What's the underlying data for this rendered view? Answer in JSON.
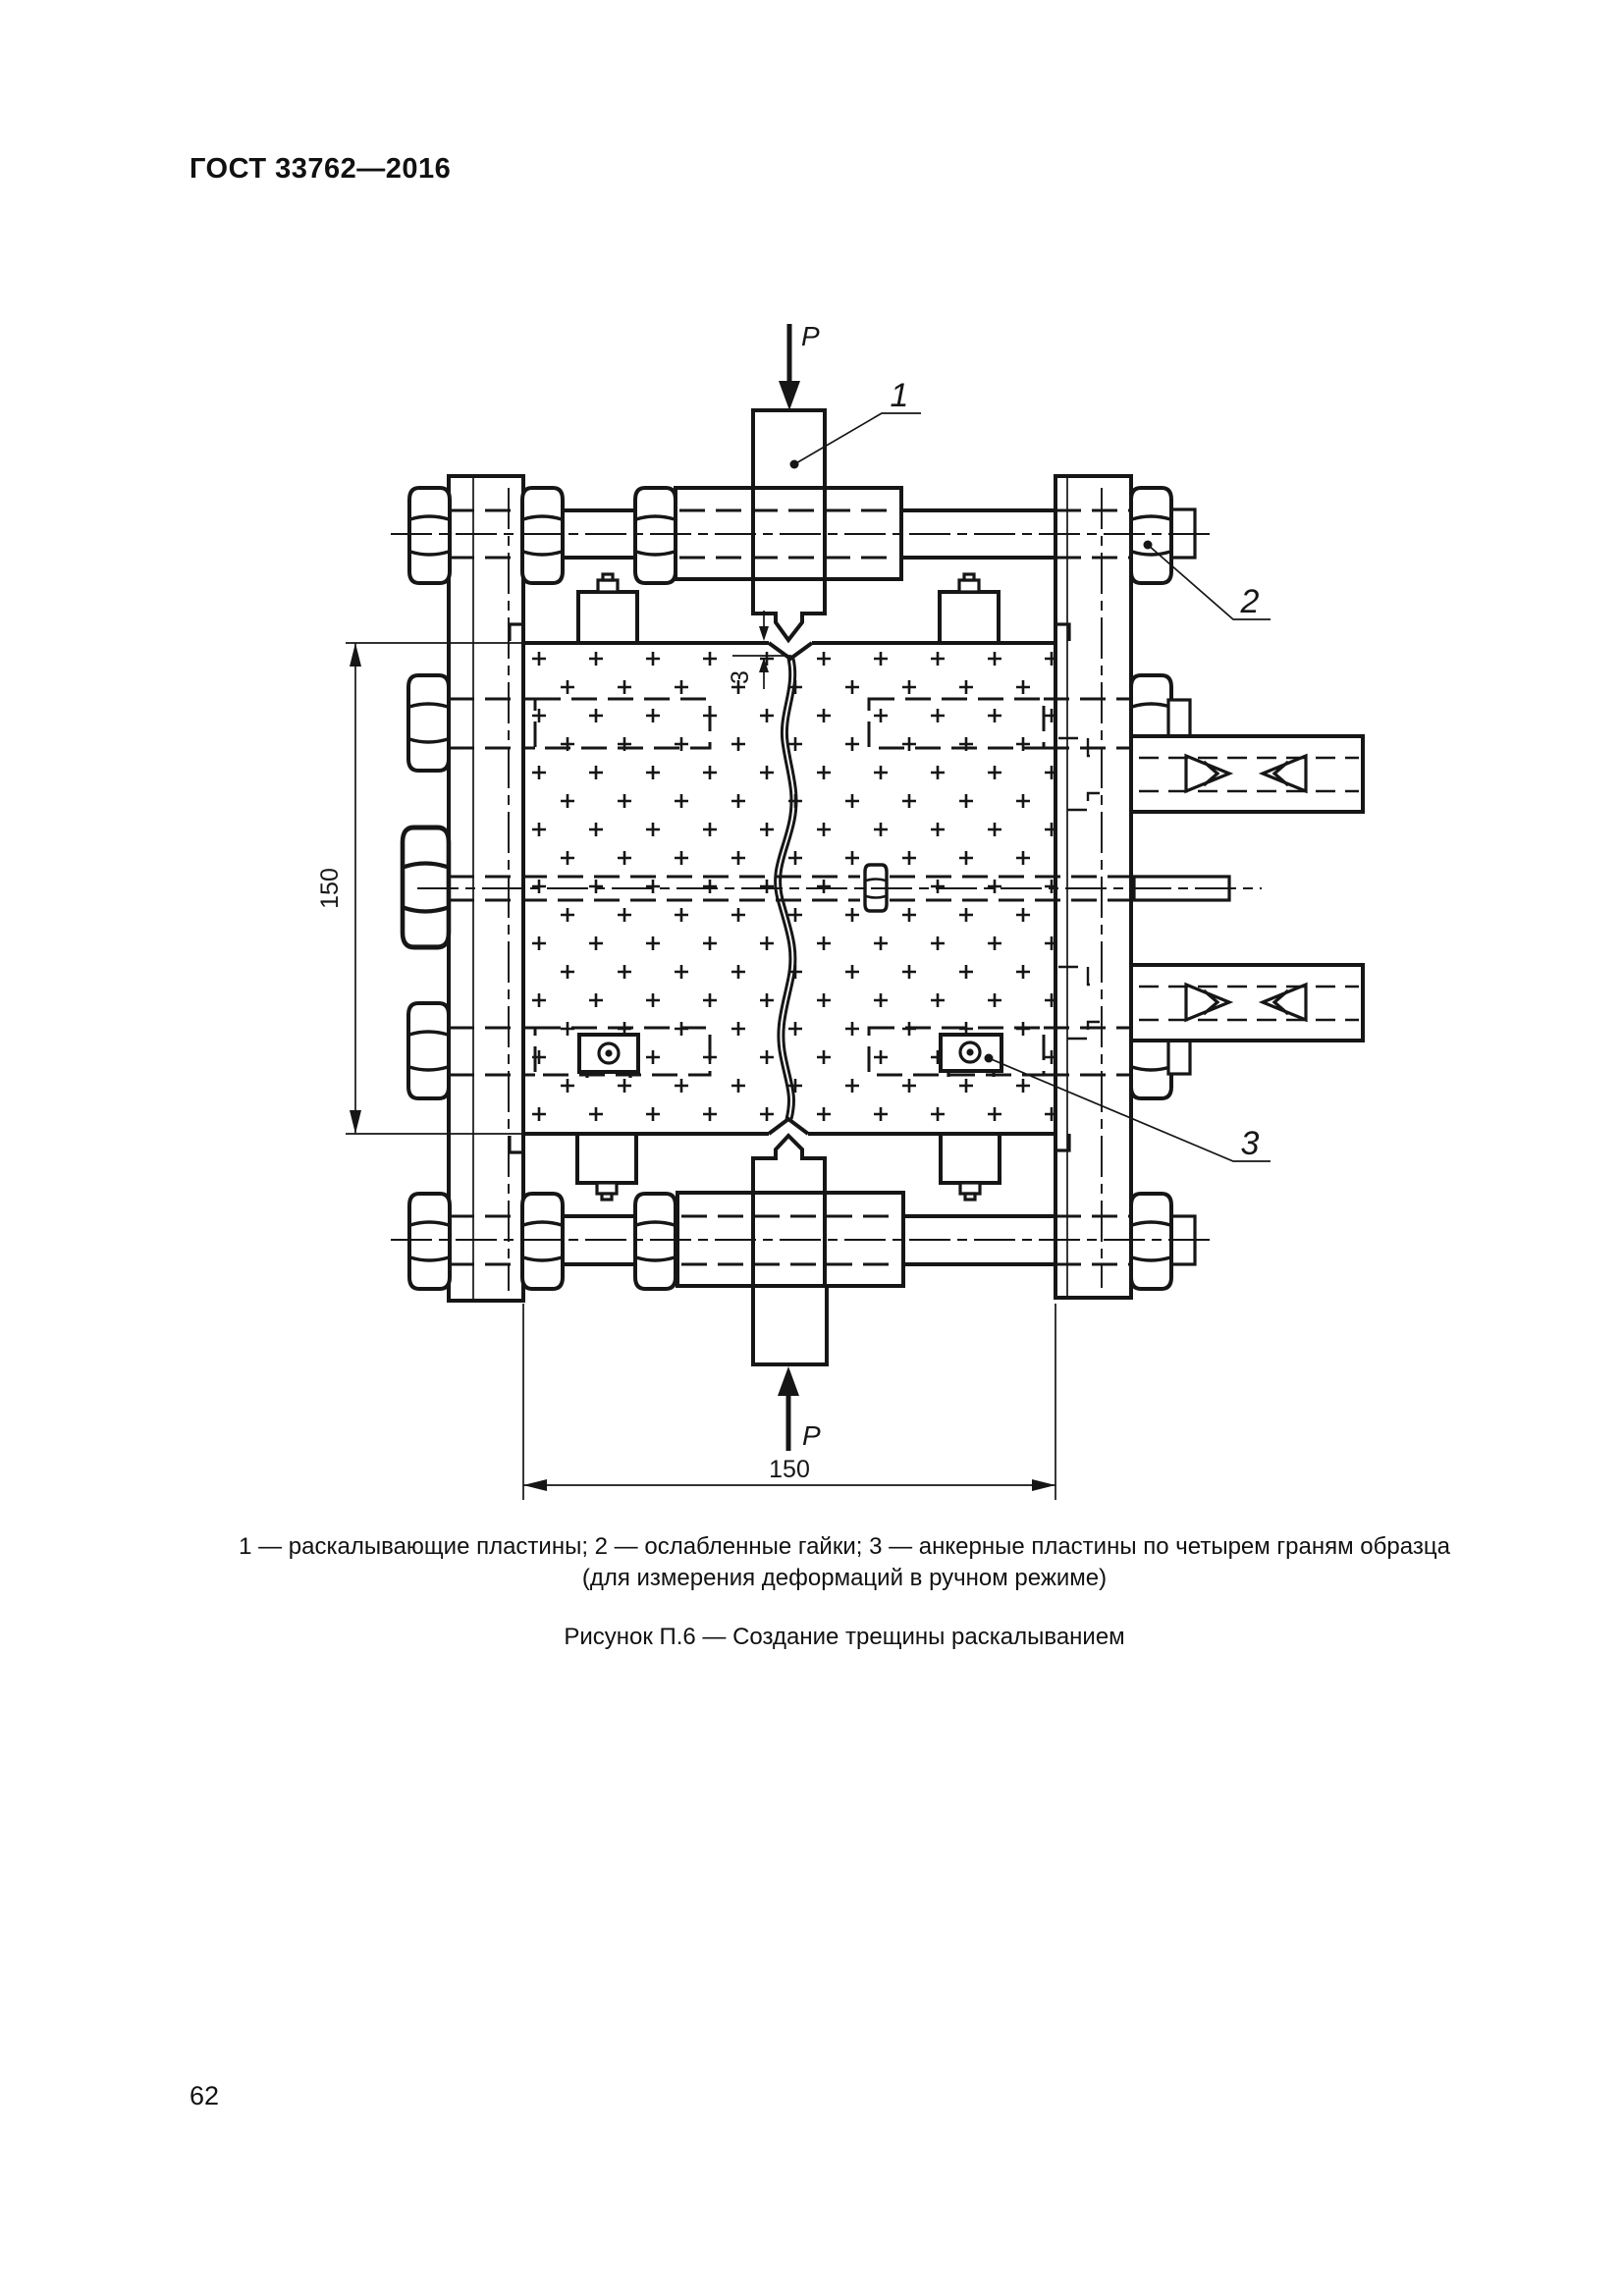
{
  "page": {
    "header": "ГОСТ 33762—2016",
    "page_number": "62"
  },
  "figure": {
    "force_label_top": "P",
    "force_label_bottom": "P",
    "callout_1": "1",
    "callout_2": "2",
    "callout_3": "3",
    "dim_height": "150",
    "dim_width": "150",
    "dim_notch_depth": "3",
    "caption_line1": "1 — раскалывающие пластины; 2 — ослабленные гайки; 3 — анкерные пластины по четырем граням образца",
    "caption_line2": "(для измерения деформаций в ручном режиме)",
    "figure_caption": "Рисунок П.6 — Создание трещины раскалыванием"
  }
}
